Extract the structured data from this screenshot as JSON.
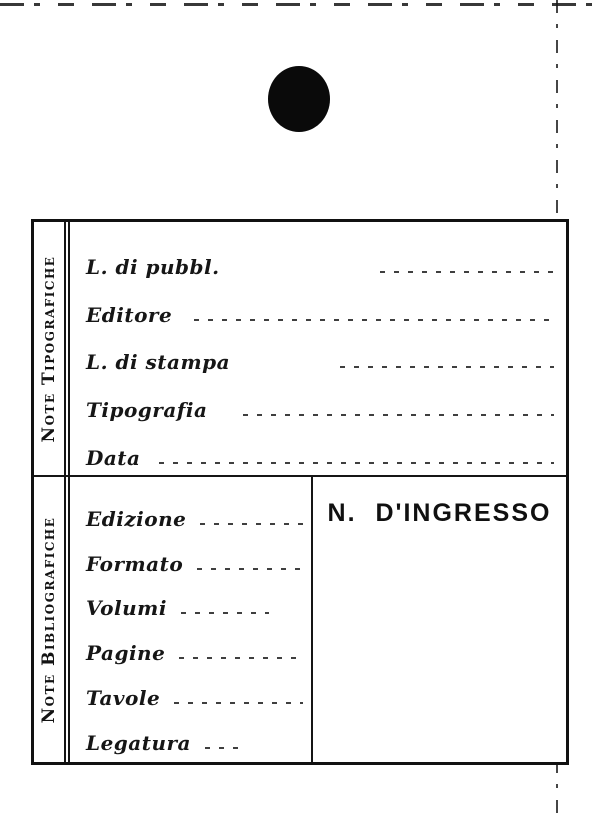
{
  "colors": {
    "ink": "#141414",
    "paper": "#ffffff"
  },
  "decorations": {
    "punch_hole": "filled-circle"
  },
  "card": {
    "sections": [
      {
        "side_label": "Note Tipografiche",
        "fields": [
          {
            "label": "L. di pubbl.",
            "value": ""
          },
          {
            "label": "Editore",
            "value": ""
          },
          {
            "label": "L. di stampa",
            "value": ""
          },
          {
            "label": "Tipografia",
            "value": ""
          },
          {
            "label": "Data",
            "value": ""
          }
        ]
      },
      {
        "side_label": "Note Bibliografiche",
        "fields": [
          {
            "label": "Edizione",
            "value": ""
          },
          {
            "label": "Formato",
            "value": ""
          },
          {
            "label": "Volumi",
            "value": ""
          },
          {
            "label": "Pagine",
            "value": ""
          },
          {
            "label": "Tavole",
            "value": ""
          },
          {
            "label": "Legatura",
            "value": ""
          }
        ],
        "accession_cell": {
          "title": "N. D'INGRESSO",
          "value": ""
        }
      }
    ]
  }
}
